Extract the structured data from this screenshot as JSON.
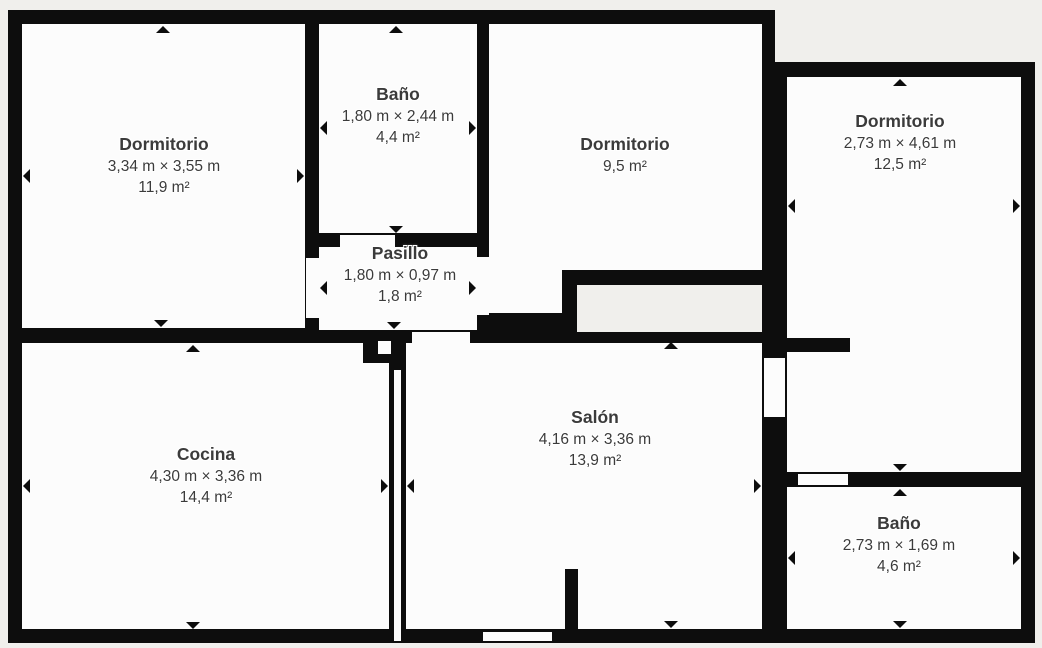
{
  "palette": {
    "wall_color": "#0d0d0d",
    "room_fill": "#fcfcfc",
    "background": "#f0efec",
    "text_color": "#3b3b3b",
    "marker_color": "#0d0d0d"
  },
  "rooms": [
    {
      "name": "Dormitorio",
      "dimensions": "3,34 m × 3,55 m",
      "area": "11,9 m²"
    },
    {
      "name": "Baño",
      "dimensions": "1,80 m × 2,44 m",
      "area": "4,4 m²"
    },
    {
      "name": "Dormitorio",
      "area": "9,5 m²"
    },
    {
      "name": "Dormitorio",
      "dimensions": "2,73 m × 4,61 m",
      "area": "12,5 m²"
    },
    {
      "name": "Pasillo",
      "dimensions": "1,80 m × 0,97 m",
      "area": "1,8 m²"
    },
    {
      "name": "Cocina",
      "dimensions": "4,30 m × 3,36 m",
      "area": "14,4 m²"
    },
    {
      "name": "Salón",
      "dimensions": "4,16 m × 3,36 m",
      "area": "13,9 m²"
    },
    {
      "name": "Baño",
      "dimensions": "2,73 m × 1,69 m",
      "area": "4,6 m²"
    }
  ]
}
